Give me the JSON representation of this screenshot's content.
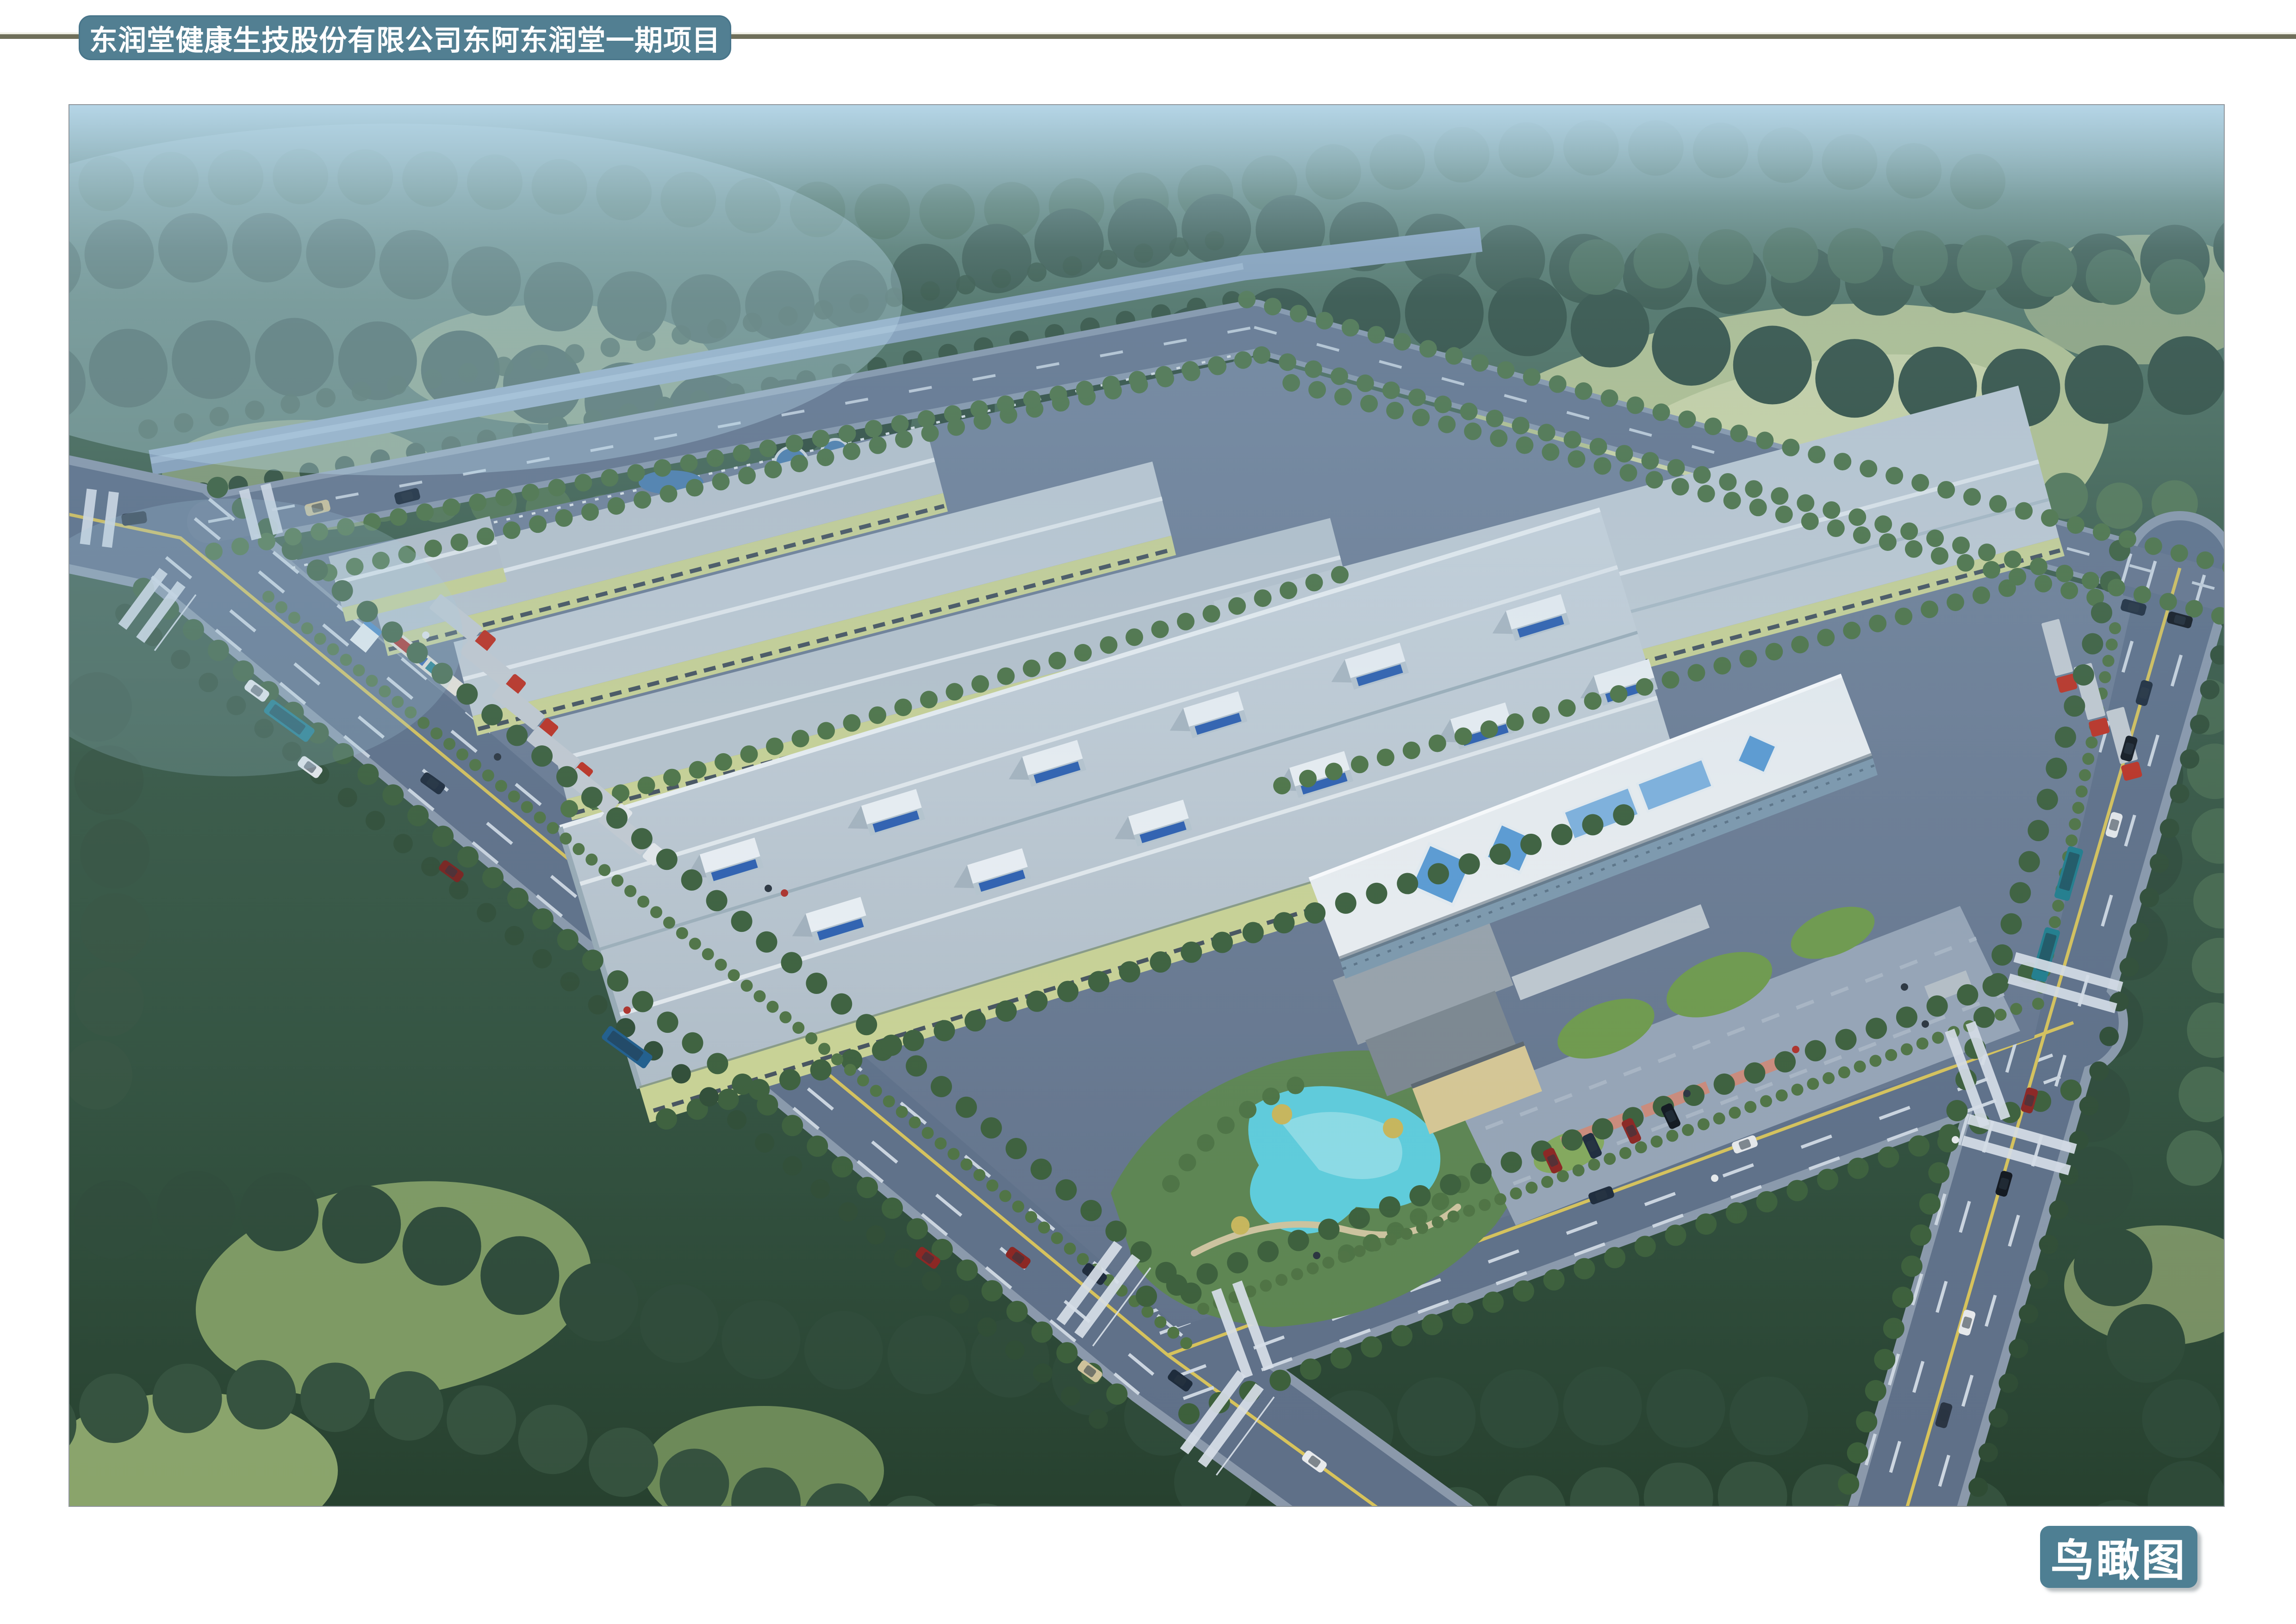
{
  "header": {
    "title": "东润堂健康生技股份有限公司东阿东润堂一期项目"
  },
  "caption": {
    "label": "鸟瞰图"
  },
  "colors": {
    "accent_teal": "#527f92",
    "caption_teal": "#4e7f93",
    "rule_olive": "#6f6f5a",
    "title_text": "#ffffff",
    "roof_gray": "#c4cdd5",
    "wall_yellow_green": "#ccd494",
    "glass_blue": "#2d5fb0",
    "skylight_pyramid_blue": "#5a9bd4",
    "pond_turquoise": "#5ecddc",
    "road_slate": "#5f7088",
    "forest_green": "#2f4d3a",
    "meadow_green": "#b9c68d",
    "haze_blue": "#b9d9ec",
    "truck_red": "#c03020",
    "bus_teal": "#1f7d8c"
  },
  "scene": {
    "kind": "architectural-aerial-rendering",
    "subject": "factory campus bird's-eye view with warehouses, office building, perimeter roads, canal, garden pond and surrounding forest"
  }
}
